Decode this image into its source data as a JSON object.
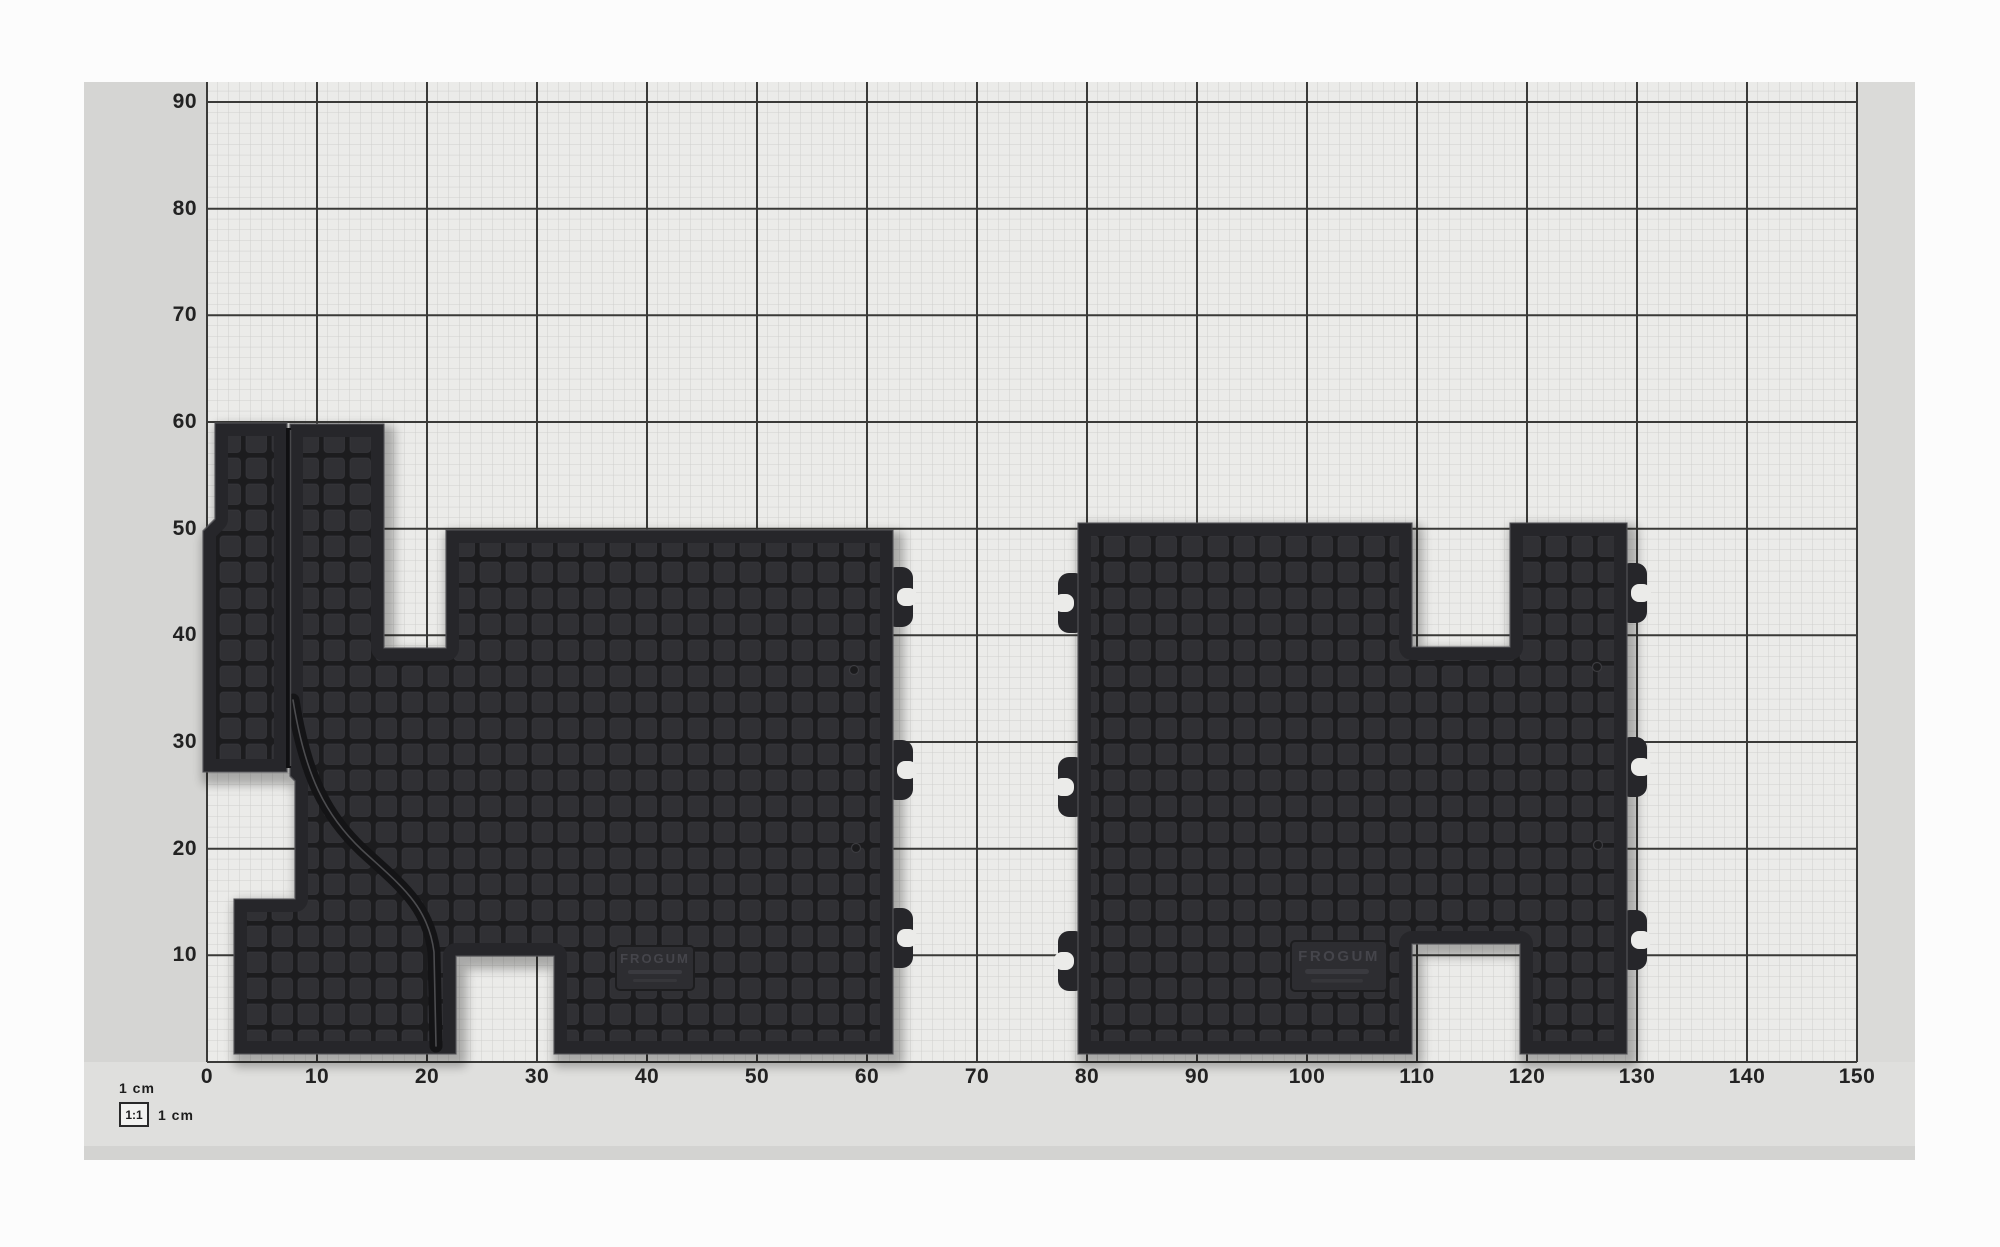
{
  "axes": {
    "x_ticks": [
      "0",
      "10",
      "20",
      "30",
      "40",
      "50",
      "60",
      "70",
      "80",
      "90",
      "100",
      "110",
      "120",
      "130",
      "140",
      "150"
    ],
    "y_ticks": [
      "10",
      "20",
      "30",
      "40",
      "50",
      "60",
      "70",
      "80",
      "90"
    ]
  },
  "scale_legend": {
    "top_label": "1 cm",
    "ratio_label": "1:1",
    "side_label": "1 cm"
  },
  "mats": {
    "logo_text": "FROGUM"
  },
  "colors": {
    "paper": "#ebebe9",
    "photo_margin": "#dfdfdd",
    "photo_margin_side": "#d5d5d3",
    "grid_minor": "#cfcfcd",
    "grid_major": "#3a3a38",
    "label": "#222222",
    "mat_body": "#26262a",
    "mat_cell": "#303034",
    "mat_groove": "#1c1c1e",
    "mat_rim": "#55555a",
    "logo_emboss": "#45454b"
  }
}
